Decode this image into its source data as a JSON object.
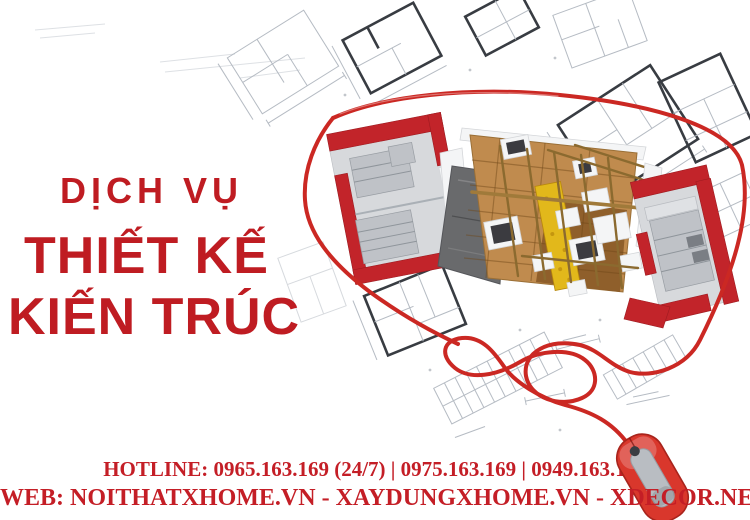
{
  "meta": {
    "description_vi": "Quang cao dich vu thiet ke kien truc"
  },
  "headline": {
    "line1": "DỊCH VỤ",
    "line2": "THIẾT KẾ",
    "line3": "KIẾN TRÚC"
  },
  "footer": {
    "hotline_label": "HOTLINE:",
    "hotline_numbers": [
      "0965.163.169 (24/7)",
      "0975.163.169",
      "0949.163.169"
    ],
    "hotline_text": "HOTLINE: 0965.163.169 (24/7) | 0975.163.169 | 0949.163.169",
    "web_label": "WEB:",
    "websites": [
      "NOITHATXHOME.VN",
      "XAYDUNGXHOME.VN",
      "XDECOR.NET"
    ],
    "web_text": "WEB: NOITHATXHOME.VN - XAYDUNGXHOME.VN - XDECOR.NET"
  },
  "illustration": {
    "background": "architectural-blueprint-drawings",
    "center": "3d-cutaway-house-floor-plan-model",
    "cable": "red-mouse-cable-looping-around-model",
    "bottom_right": "red-computer-mouse"
  },
  "colors": {
    "headline_red": "#bf1c22",
    "footer_red": "#c41e26",
    "cable_red": "#cb2823",
    "mouse_red": "#d9372c",
    "mouse_dark_red": "#a8241c",
    "wall_red": "#c2242a",
    "wood": "#c08b4e",
    "wood_dark": "#8a5a28",
    "roof_gray": "#696a6c",
    "insulation_yellow": "#e2b81b",
    "beam_brown": "#8b6a2f",
    "blueprint_gray": "#b5bbc3",
    "blueprint_dark": "#383c42",
    "background": "#ffffff"
  }
}
